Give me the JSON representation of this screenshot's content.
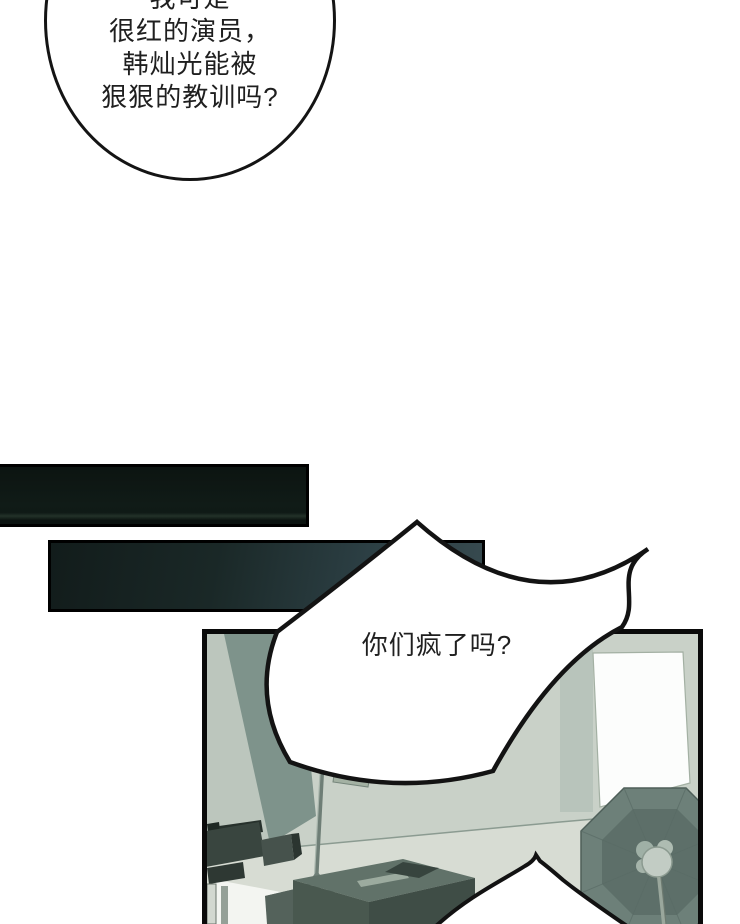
{
  "bubbles": {
    "round": {
      "lines": [
        "我可是",
        "很红的演员，",
        "韩灿光能被",
        "狠狠的教训吗?"
      ]
    },
    "shout": {
      "text": "你们疯了吗?"
    }
  },
  "palette": {
    "page": "#ffffff",
    "ink": "#141414",
    "text": "#1f1f1f",
    "wall": "#c9d1c8",
    "wall-dark": "#7e938b",
    "wall-mid": "#bcc6bd",
    "floor": "#d7dcd3"
  },
  "scene": {
    "elements": [
      "video-camera",
      "light-stand",
      "equipment-cases",
      "octagonal-softbox",
      "backdrop-panel",
      "bottom-speech-bubble"
    ]
  }
}
